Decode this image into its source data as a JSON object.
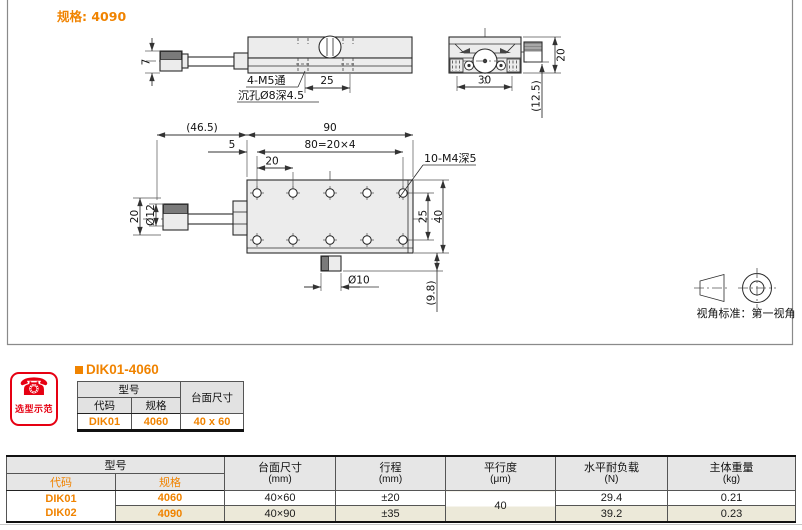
{
  "colors": {
    "accent": "#F08300",
    "badge_red": "#E60012",
    "row_alt": "#ECE9D9",
    "header_gray": "#E6E6E6"
  },
  "icons": {
    "phone_glyph": "☎"
  },
  "drawing": {
    "spec_label": "规格: 4090",
    "view_note": "视角标准：第一视角",
    "front_view": {
      "dim_height": "7",
      "label_m5": "4-M5通",
      "label_counterbore": "沉孔Ø8深4.5",
      "dim_pitch": "25"
    },
    "end_view": {
      "dim_width": "30",
      "dim_height": "20",
      "dim_center_height": "(12.5)"
    },
    "top_view": {
      "dim_overhang": "(46.5)",
      "dim_length": "90",
      "dim_edge": "5",
      "dim_hole_span": "80=20×4",
      "dim_hole_pitch": "20",
      "label_m4": "10-M4深5",
      "dim_knob_dia": "Ø12",
      "dim_body_height": "20",
      "dim_hole_row_span": "25",
      "dim_width": "40",
      "dim_lock_dia": "Ø10",
      "dim_lock_offset": "(9.8)"
    }
  },
  "selection_example": {
    "badge_label": "选型示范",
    "title": "DIK01-4060",
    "table": {
      "header_model": "型号",
      "header_code": "代码",
      "header_spec": "规格",
      "header_table_size": "台面尺寸",
      "row": {
        "code": "DIK01",
        "spec": "4060",
        "table_size": "40 x 60"
      }
    }
  },
  "spec_table": {
    "header_model": "型号",
    "header_code": "代码",
    "header_spec": "规格",
    "columns": [
      {
        "label": "台面尺寸",
        "unit": "(mm)"
      },
      {
        "label": "行程",
        "unit": "(mm)"
      },
      {
        "label": "平行度",
        "unit": "(μm)"
      },
      {
        "label": "水平耐负载",
        "unit": "(N)"
      },
      {
        "label": "主体重量",
        "unit": "(kg)"
      }
    ],
    "parallelism_shared": "40",
    "rows": [
      {
        "code": "DIK01",
        "spec": "4060",
        "table_size": "40×60",
        "travel": "±20",
        "load": "29.4",
        "weight": "0.21"
      },
      {
        "code": "DIK02",
        "spec": "4090",
        "table_size": "40×90",
        "travel": "±35",
        "load": "39.2",
        "weight": "0.23"
      }
    ]
  }
}
